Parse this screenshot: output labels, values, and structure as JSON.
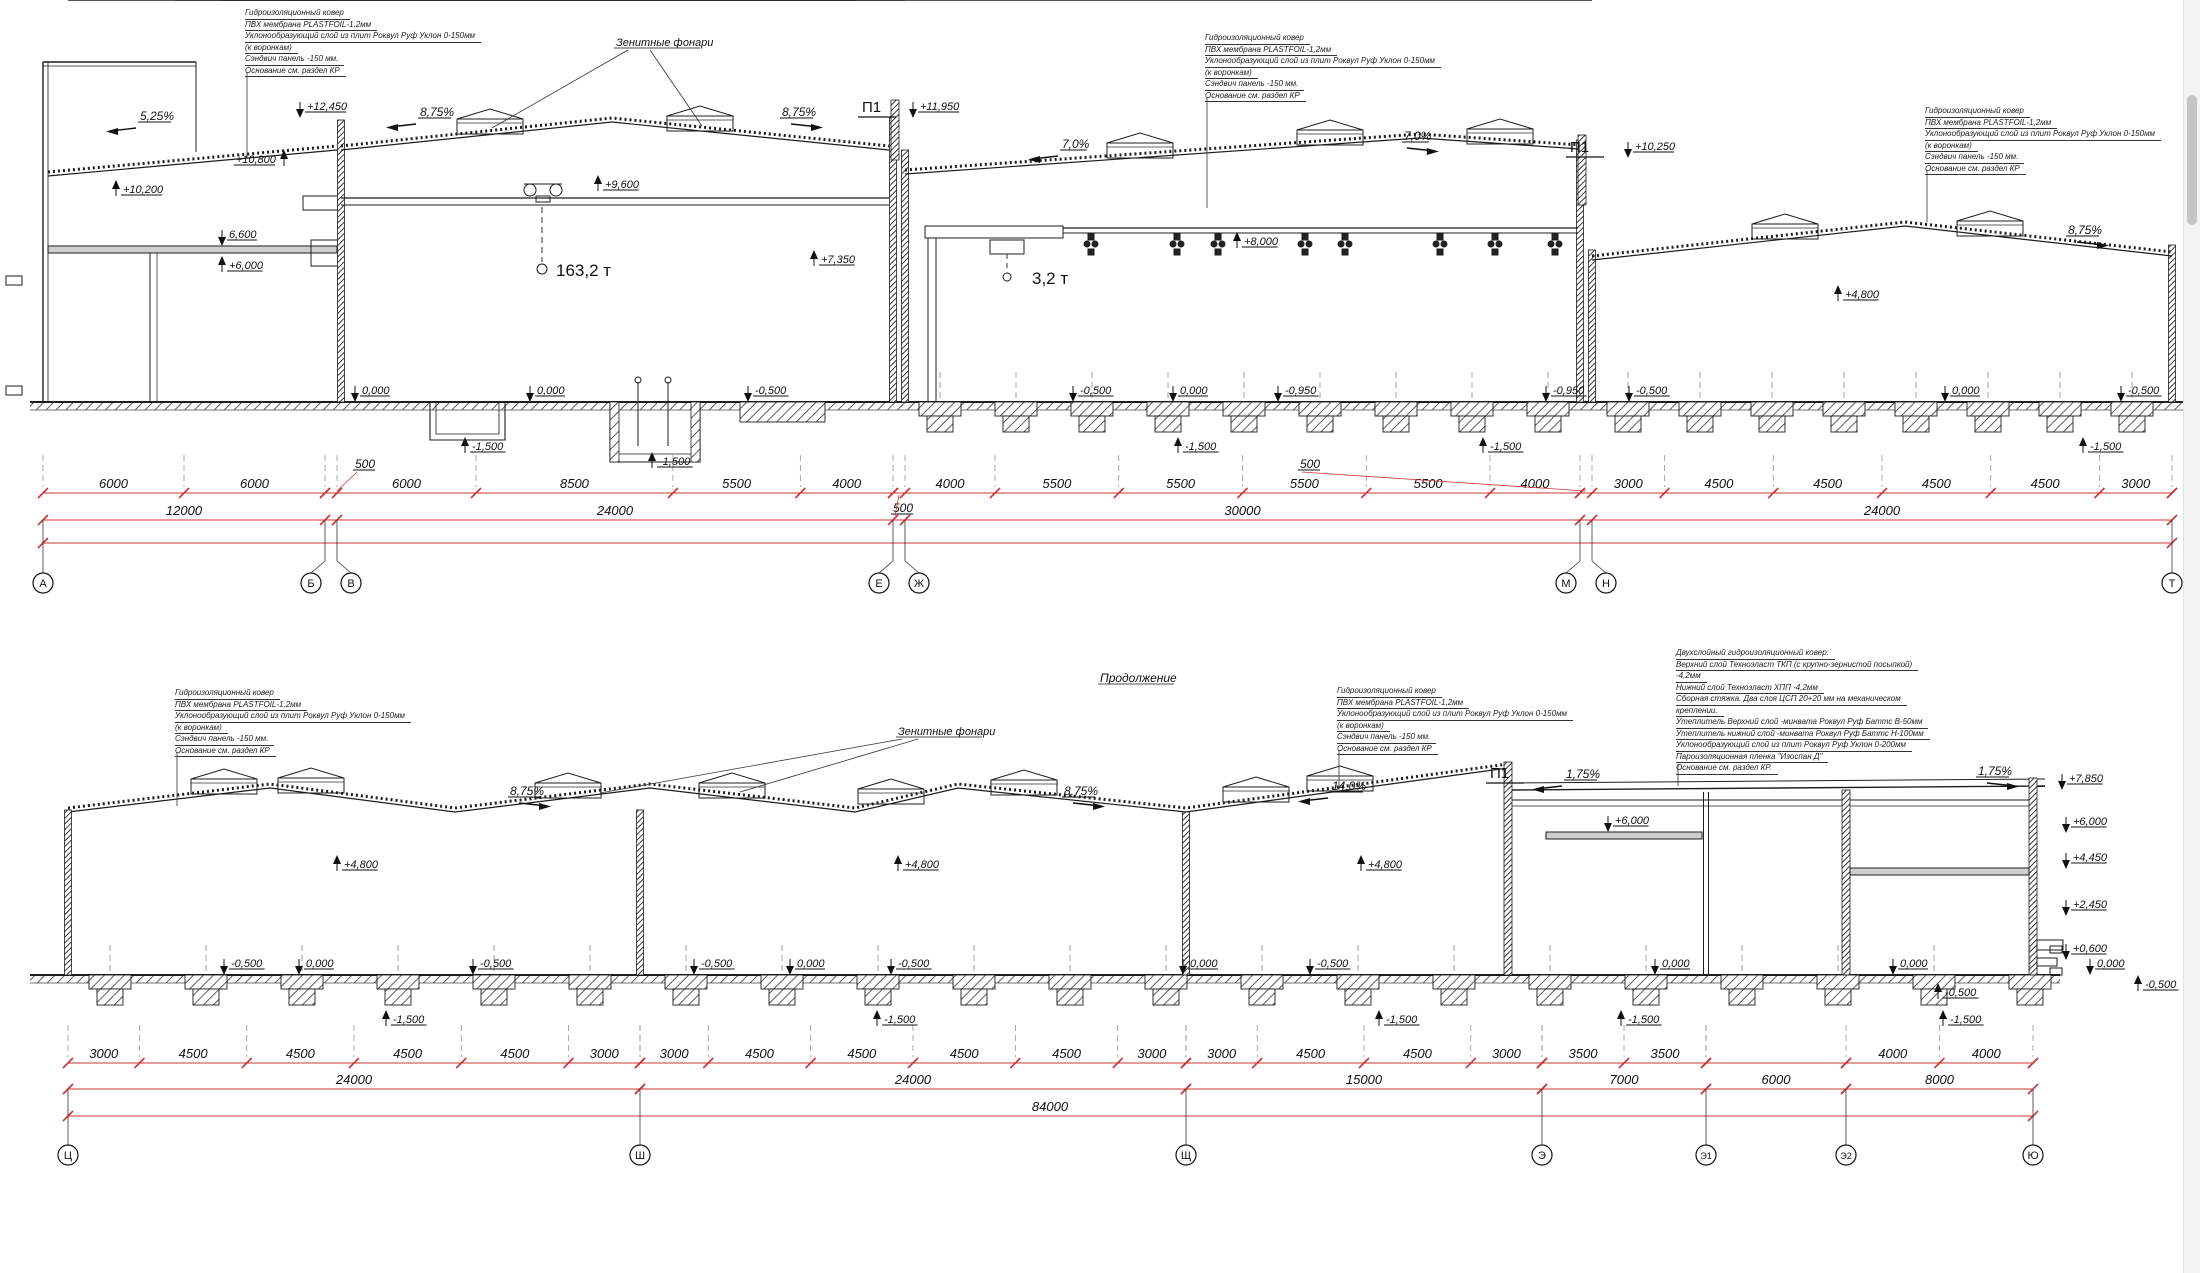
{
  "page": {
    "background": "#ffffff",
    "line_color": "#1d1d1d",
    "dim_color": "#cc3434"
  },
  "annotations": {
    "standard_roof_layers": [
      "Гидроизоляционный ковер",
      "ПВХ мембрана PLASTFOIL-1,2мм",
      "Уклонообразующий слой из плит Роквул Руф Уклон 0-150мм",
      "(к воронкам)",
      "Сэндвич панель -150 мм.",
      "Основание см. раздел КР"
    ],
    "detailed_roof_layers": [
      "Двухслойный гидроизоляционный ковер:",
      "Верхний слой Техноэласт ТКП (с крупно-зернистой посыпкой)",
      "-4,2мм",
      "Нижний слой Техноэласт ХПП -4,2мм",
      "Сборная стяжка. Два слоя ЦСП 20+20 мм на механическом",
      "креплении.",
      "Утеплитель Верхний слой -минвата Роквул Руф Баттс В-50мм",
      "Утеплитель нижний слой -минвата Роквул Руф Баттс Н-100мм",
      "Уклонообразующий слой из плит Роквул Руф Уклон 0-200мм",
      "Пароизоляционная пленка \"Изоспан Д\"",
      "Основание см. раздел КР."
    ]
  },
  "labels": {
    "skylights": "Зенитные фонари",
    "continuation": "Продолжение",
    "panel_joint": "П1"
  },
  "top_section": {
    "axes": [
      {
        "label": "А",
        "x": 43,
        "bx": 43
      },
      {
        "label": "Б",
        "x": 325,
        "bx": 311
      },
      {
        "label": "В",
        "x": 337,
        "bx": 351
      },
      {
        "label": "Е",
        "x": 893,
        "bx": 879
      },
      {
        "label": "Ж",
        "x": 905,
        "bx": 919
      },
      {
        "label": "М",
        "x": 1580,
        "bx": 1566
      },
      {
        "label": "Н",
        "x": 1592,
        "bx": 1606
      },
      {
        "label": "Т",
        "x": 2172,
        "bx": 2172
      }
    ],
    "dims": {
      "segments": [
        {
          "x1": 43,
          "x2": 325,
          "parts": [
            6000,
            6000
          ],
          "total": "12000"
        },
        {
          "x1": 337,
          "x2": 893,
          "parts": [
            6000,
            8500,
            5500,
            4000
          ],
          "total": "24000"
        },
        {
          "x1": 905,
          "x2": 1580,
          "parts": [
            4000,
            5500,
            5500,
            5500,
            5500,
            4000
          ],
          "total": "30000"
        },
        {
          "x1": 1592,
          "x2": 2172,
          "parts": [
            3000,
            4500,
            4500,
            4500,
            4500,
            3000
          ],
          "total": "24000"
        }
      ],
      "offsets": [
        {
          "text": "500",
          "x": 355,
          "y": 468,
          "lx": 337,
          "ly": 491
        },
        {
          "text": "500",
          "x": 893,
          "y": 512,
          "lx": 899,
          "ly": 495
        },
        {
          "text": "500",
          "x": 1300,
          "y": 468,
          "lx": 1586,
          "ly": 491
        }
      ],
      "grand_total": null
    },
    "elevations": [
      {
        "text": "+12,450",
        "x": 300,
        "y": 118,
        "dir": "down"
      },
      {
        "text": "+10,800",
        "x": 284,
        "y": 150,
        "dir": "up",
        "side": "left"
      },
      {
        "text": "+10,200",
        "x": 116,
        "y": 180,
        "dir": "up"
      },
      {
        "text": "6,600",
        "x": 222,
        "y": 246,
        "dir": "down"
      },
      {
        "text": "+6,000",
        "x": 222,
        "y": 256,
        "dir": "up"
      },
      {
        "text": "+9,600",
        "x": 598,
        "y": 175,
        "dir": "up"
      },
      {
        "text": "+7,350",
        "x": 814,
        "y": 250,
        "dir": "up"
      },
      {
        "text": "+11,950",
        "x": 913,
        "y": 118,
        "dir": "down"
      },
      {
        "text": "+10,250",
        "x": 1628,
        "y": 158,
        "dir": "down"
      },
      {
        "text": "+8,000",
        "x": 1237,
        "y": 232,
        "dir": "up"
      },
      {
        "text": "+4,800",
        "x": 1838,
        "y": 285,
        "dir": "up"
      },
      {
        "text": "0,000",
        "x": 355,
        "y": 402,
        "dir": "down"
      },
      {
        "text": "0,000",
        "x": 530,
        "y": 402,
        "dir": "down"
      },
      {
        "text": "-0,500",
        "x": 748,
        "y": 402,
        "dir": "down"
      },
      {
        "text": "-0,500",
        "x": 1073,
        "y": 402,
        "dir": "down"
      },
      {
        "text": "0,000",
        "x": 1173,
        "y": 402,
        "dir": "down"
      },
      {
        "text": "-0,950",
        "x": 1278,
        "y": 402,
        "dir": "down"
      },
      {
        "text": "-0,950",
        "x": 1546,
        "y": 402,
        "dir": "down"
      },
      {
        "text": "-0,500",
        "x": 1629,
        "y": 402,
        "dir": "down"
      },
      {
        "text": "0,000",
        "x": 1945,
        "y": 402,
        "dir": "down"
      },
      {
        "text": "-0,500",
        "x": 2121,
        "y": 402,
        "dir": "down"
      },
      {
        "text": "-1,500",
        "x": 465,
        "y": 437,
        "dir": "up"
      },
      {
        "text": "-1,500",
        "x": 652,
        "y": 452,
        "dir": "up"
      },
      {
        "text": "-1,500",
        "x": 1178,
        "y": 437,
        "dir": "up"
      },
      {
        "text": "-1,500",
        "x": 1483,
        "y": 437,
        "dir": "up"
      },
      {
        "text": "-1,500",
        "x": 2083,
        "y": 437,
        "dir": "up"
      }
    ],
    "slopes": [
      {
        "text": "5,25%",
        "x": 140,
        "y": 120,
        "dir": "left"
      },
      {
        "text": "8,75%",
        "x": 420,
        "y": 116,
        "dir": "left"
      },
      {
        "text": "8,75%",
        "x": 782,
        "y": 116,
        "dir": "right"
      },
      {
        "text": "7,0%",
        "x": 1062,
        "y": 148,
        "dir": "left"
      },
      {
        "text": "7,0%",
        "x": 1404,
        "y": 140,
        "dir": "right"
      },
      {
        "text": "8,75%",
        "x": 2068,
        "y": 234,
        "dir": "right"
      }
    ],
    "p1_positions": [
      {
        "x": 862,
        "y": 112
      },
      {
        "x": 1570,
        "y": 152
      }
    ],
    "cranes": [
      {
        "text": "163,2 т",
        "x": 556,
        "y": 276
      },
      {
        "text": "3,2 т",
        "x": 1032,
        "y": 284
      }
    ],
    "skylight_label": {
      "x": 616,
      "y": 46
    }
  },
  "bottom_section": {
    "axes": [
      {
        "label": "Ц",
        "x": 68,
        "bx": 68
      },
      {
        "label": "Ш",
        "x": 640,
        "bx": 640
      },
      {
        "label": "Щ",
        "x": 1186,
        "bx": 1186
      },
      {
        "label": "Э",
        "x": 1542,
        "bx": 1542
      },
      {
        "label": "Э1",
        "x": 1706,
        "bx": 1706
      },
      {
        "label": "Э2",
        "x": 1846,
        "bx": 1846
      },
      {
        "label": "Ю",
        "x": 2033,
        "bx": 2033
      }
    ],
    "dims": {
      "segments": [
        {
          "x1": 68,
          "x2": 640,
          "parts": [
            3000,
            4500,
            4500,
            4500,
            4500,
            3000
          ],
          "total": "24000"
        },
        {
          "x1": 640,
          "x2": 1186,
          "parts": [
            3000,
            4500,
            4500,
            4500,
            4500,
            3000
          ],
          "total": "24000"
        },
        {
          "x1": 1186,
          "x2": 1542,
          "parts": [
            3000,
            4500,
            4500,
            3000
          ],
          "total": "15000"
        },
        {
          "x1": 1542,
          "x2": 1706,
          "parts": [
            3500,
            3500
          ],
          "total": "7000"
        },
        {
          "x1": 1706,
          "x2": 1846,
          "parts": [],
          "total": "6000"
        },
        {
          "x1": 1846,
          "x2": 2033,
          "parts": [
            4000,
            4000
          ],
          "total": "8000"
        }
      ],
      "offsets": [],
      "grand_total": {
        "text": "84000",
        "x": 1050
      }
    },
    "elevations": [
      {
        "text": "+4,800",
        "x": 337,
        "y": 855,
        "dir": "up"
      },
      {
        "text": "+4,800",
        "x": 898,
        "y": 855,
        "dir": "up"
      },
      {
        "text": "+4,800",
        "x": 1361,
        "y": 855,
        "dir": "up"
      },
      {
        "text": "+6,000",
        "x": 1608,
        "y": 832,
        "dir": "down"
      },
      {
        "text": "+7,850",
        "x": 2062,
        "y": 790,
        "dir": "down"
      },
      {
        "text": "+6,000",
        "x": 2066,
        "y": 833,
        "dir": "down"
      },
      {
        "text": "+4,450",
        "x": 2066,
        "y": 869,
        "dir": "down"
      },
      {
        "text": "+2,450",
        "x": 2066,
        "y": 916,
        "dir": "down"
      },
      {
        "text": "+0,600",
        "x": 2066,
        "y": 960,
        "dir": "down"
      },
      {
        "text": "0,000",
        "x": 2090,
        "y": 975,
        "dir": "down"
      },
      {
        "text": "-0,500",
        "x": 2138,
        "y": 975,
        "dir": "up"
      },
      {
        "text": "-0,500",
        "x": 224,
        "y": 975,
        "dir": "down"
      },
      {
        "text": "0,000",
        "x": 299,
        "y": 975,
        "dir": "down"
      },
      {
        "text": "-0,500",
        "x": 473,
        "y": 975,
        "dir": "down"
      },
      {
        "text": "-0,500",
        "x": 694,
        "y": 975,
        "dir": "down"
      },
      {
        "text": "0,000",
        "x": 790,
        "y": 975,
        "dir": "down"
      },
      {
        "text": "-0,500",
        "x": 891,
        "y": 975,
        "dir": "down"
      },
      {
        "text": "0,000",
        "x": 1183,
        "y": 975,
        "dir": "down"
      },
      {
        "text": "-0,500",
        "x": 1310,
        "y": 975,
        "dir": "down"
      },
      {
        "text": "0,000",
        "x": 1655,
        "y": 975,
        "dir": "down"
      },
      {
        "text": "0,000",
        "x": 1893,
        "y": 975,
        "dir": "down"
      },
      {
        "text": "-0,500",
        "x": 1938,
        "y": 983,
        "dir": "up"
      },
      {
        "text": "-1,500",
        "x": 386,
        "y": 1010,
        "dir": "up"
      },
      {
        "text": "-1,500",
        "x": 877,
        "y": 1010,
        "dir": "up"
      },
      {
        "text": "-1,500",
        "x": 1379,
        "y": 1010,
        "dir": "up"
      },
      {
        "text": "-1,500",
        "x": 1621,
        "y": 1010,
        "dir": "up"
      },
      {
        "text": "-1,500",
        "x": 1943,
        "y": 1010,
        "dir": "up"
      }
    ],
    "slopes": [
      {
        "text": "8,75%",
        "x": 510,
        "y": 795,
        "dir": "right"
      },
      {
        "text": "8,75%",
        "x": 1064,
        "y": 795,
        "dir": "right"
      },
      {
        "text": "14,0%",
        "x": 1332,
        "y": 790,
        "dir": "left"
      },
      {
        "text": "1,75%",
        "x": 1566,
        "y": 778,
        "dir": "left"
      },
      {
        "text": "1,75%",
        "x": 1978,
        "y": 775,
        "dir": "right"
      }
    ],
    "p1_positions": [
      {
        "x": 1490,
        "y": 778
      }
    ],
    "cranes": [],
    "skylight_label": {
      "x": 898,
      "y": 735
    },
    "continuation_label": {
      "x": 1100,
      "y": 682
    }
  }
}
